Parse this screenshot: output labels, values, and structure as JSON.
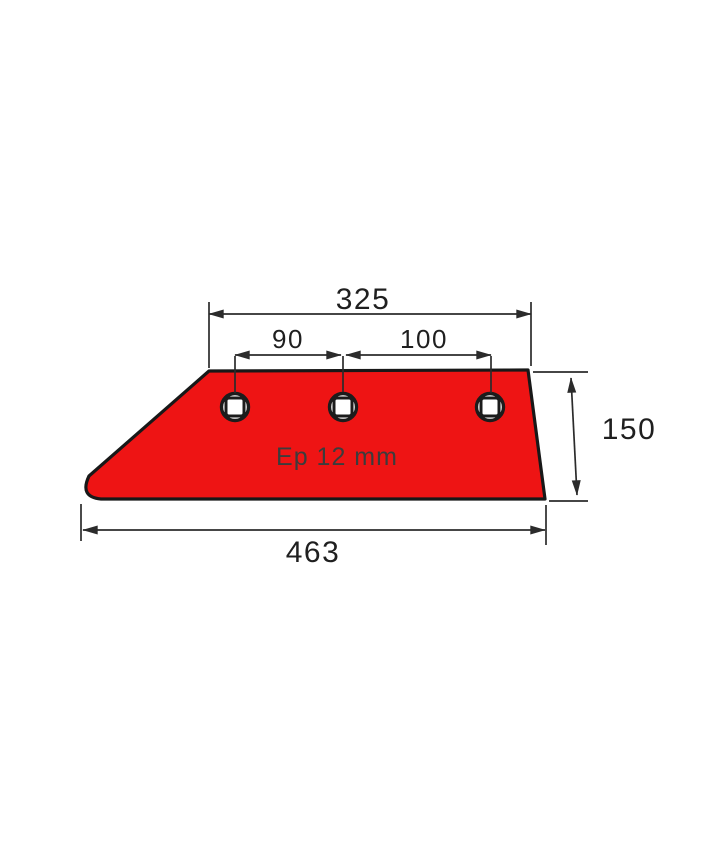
{
  "drawing": {
    "part": "plow-share-blade",
    "dimensions": {
      "top_hole_span": "325",
      "hole_gap_left": "90",
      "hole_gap_right": "100",
      "height_right": "150",
      "bottom_overall": "463",
      "thickness": "Ep 12 mm"
    },
    "holes": {
      "count": 3,
      "shape": "round hole with square bolt seat"
    },
    "colors": {
      "part_fill": "#ee1414",
      "part_outline": "#181818",
      "dimension": "#2b2b2b",
      "label_text": "#1f1f1f",
      "thickness_text": "#3c3c3c",
      "background": "#ffffff"
    }
  }
}
